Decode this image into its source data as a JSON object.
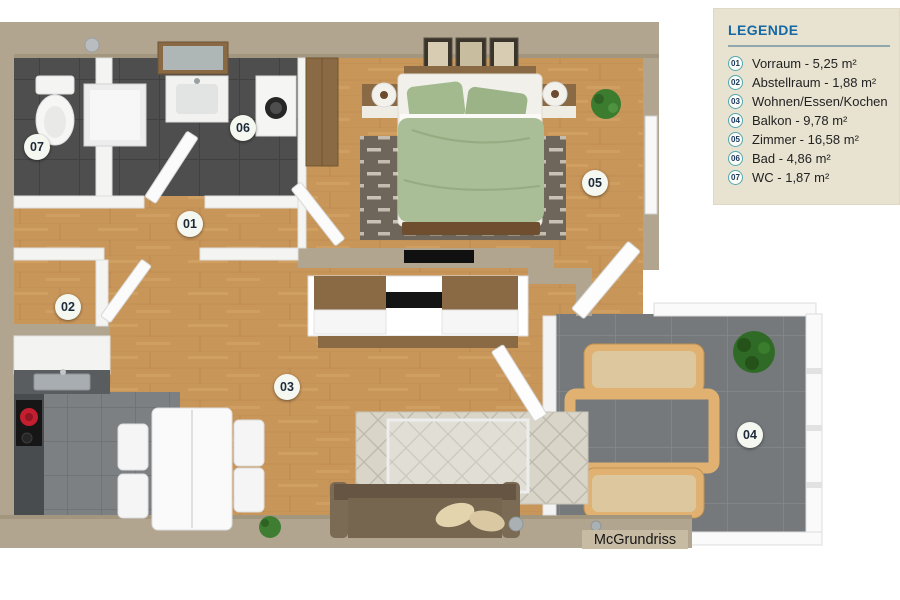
{
  "legend": {
    "title": "LEGENDE",
    "items": [
      {
        "number": "01",
        "label": "Vorraum - 5,25 m²"
      },
      {
        "number": "02",
        "label": "Abstellraum - 1,88 m²"
      },
      {
        "number": "03",
        "label": "Wohnen/Essen/Kochen"
      },
      {
        "number": "04",
        "label": "Balkon - 9,78 m²"
      },
      {
        "number": "05",
        "label": "Zimmer - 16,58 m²"
      },
      {
        "number": "06",
        "label": "Bad - 4,86 m²"
      },
      {
        "number": "07",
        "label": "WC - 1,87 m²"
      }
    ]
  },
  "plan": {
    "watermark": "McGrundriss"
  },
  "colors": {
    "legend_bg": "#e8e3d1",
    "legend_title_blue": "#1568a3",
    "legend_circle_border": "#53a7b2",
    "wall_tan": "#b2a58f",
    "wood_floor": "#c9965a",
    "bath_tile": "#4e4e4e",
    "kitchen_tile": "#7d8083",
    "balcony_tile": "#75797c",
    "bed_green": "#a9bd96",
    "sofa_brown": "#76654f",
    "badge_bg": "#f4f8f0"
  }
}
